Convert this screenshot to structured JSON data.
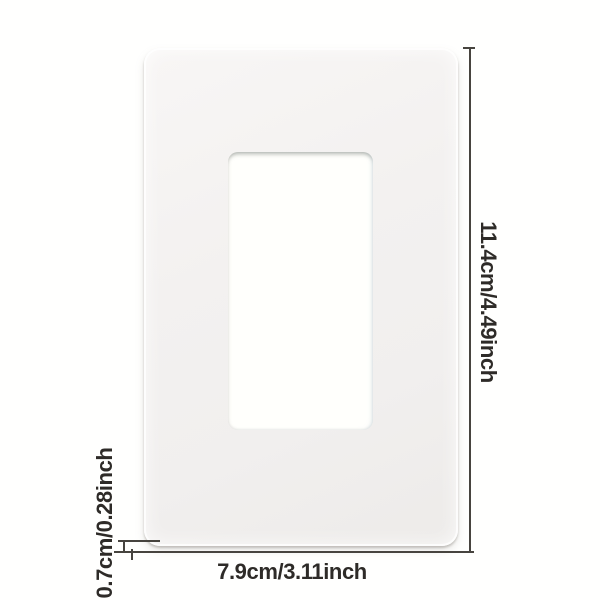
{
  "image_type": "product-dimension-diagram",
  "product": {
    "name": "white screwless single-gang decorator wall plate",
    "features": {
      "outer_shape": "rounded rectangle plate",
      "inner_shape": "rounded rectangular rocker/outlet cutout"
    }
  },
  "dimensions": {
    "height_label": "11.4cm/4.49inch",
    "width_label": "7.9cm/3.11inch",
    "thickness_label": "0.7cm/0.28inch"
  },
  "colors": {
    "background": "#fffffe",
    "plate_surface": "#f1efee",
    "cutout_fill": "#fffffc",
    "line_color": "#47443f",
    "text_color": "#2e2b28"
  }
}
